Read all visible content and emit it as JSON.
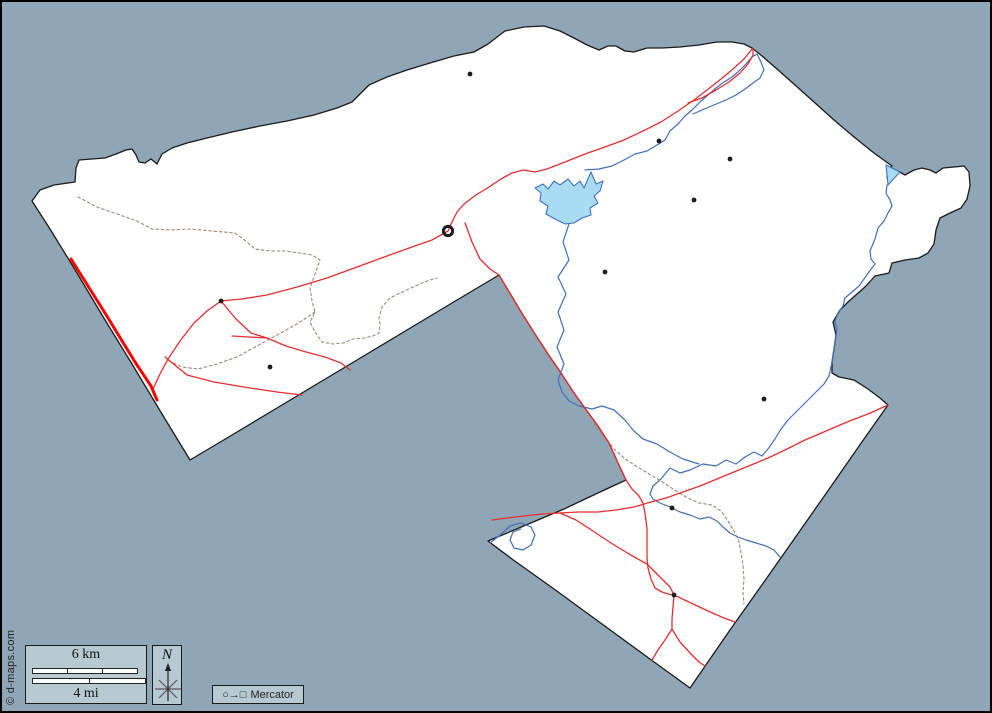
{
  "title": "Blank outline county map with roads, rivers and towns",
  "colors": {
    "sea": "#8fa6b6",
    "land": "#ffffff",
    "outline": "#1a1a1a",
    "river": "#3f6fbf",
    "water_fill": "#a9dbf3",
    "road": "#e62e2e",
    "road_major": "#ff0000",
    "trail": "#9c8674",
    "town": "#1c1c1c",
    "legend_bg": "#b7c9d3"
  },
  "legend": {
    "scale_km": "6 km",
    "scale_mi": "4 mi",
    "north": "N",
    "projection_symbols": "○→□",
    "projection": "Mercator",
    "copyright": "© d-maps.com"
  },
  "map": {
    "outline": "M30,199 L38,188 L52,183 L66,181 L73,180 L74,166 L77,158 L90,157 L103,156 L114,152 L124,148 L130,147 L134,153 L137,160 L143,161 L149,157 L155,162 L160,152 L170,146 L185,141 L205,136 L230,130 L258,124 L285,119 L312,113 L335,106 L350,100 L367,83 L385,75 L405,68 L428,61 L452,54 L472,50 L486,42 L503,29 L522,25 L542,24 L558,29 L572,36 L585,43 L597,48 L606,44 L614,44 L623,49 L632,50 L645,46 L660,46 L678,45 L697,43 L715,40 L730,40 L742,42 L750,46 L760,54 L775,67 L793,83 L812,100 L832,118 L852,135 L872,151 L890,164 L886,167 L885,176 L888,172 L896,169 L903,173 L912,168 L920,166 L928,168 L934,171 L941,166 L952,165 L962,164 L967,170 L968,184 L965,197 L959,206 L948,211 L938,216 L934,228 L932,242 L926,251 L917,256 L903,258 L890,261 L887,271 L873,274 L864,284 L855,292 L846,300 L838,308 L831,320 L834,333 L832,347 L830,360 L830,371 L837,375 L852,378 L866,387 L878,396 L886,403 L862,437 L830,483 L795,533 L762,580 L728,628 L688,686 L648,657 L600,622 L552,587 L510,557 L486,539 L524,523 L562,507 L598,490 L624,478 L617,463 L607,441 L596,424 L585,409 L572,391 L559,371 L546,352 L533,332 L521,313 L509,293 L497,273 L455,298 L410,325 L365,352 L320,379 L275,406 L230,433 L188,458 L160,412 L130,362 L100,313 L72,266 L48,227 Z",
    "lake": "M566,177 L572,184 L578,179 L582,186 L589,170 L594,182 L601,179 L598,189 L592,194 L596,201 L588,206 L589,213 L580,216 L572,221 L563,222 L553,217 L544,212 L546,204 L538,199 L539,191 L533,186 L541,182 L546,187 L552,179 L558,183 Z",
    "bay": "M884,163 L898,170 L886,183 Z",
    "rivers": [
      "M885,183 L884,191 L888,198 L890,204 L886,211 L882,219 L876,226 L873,237 L868,249 L869,257 L873,262 L867,270 L862,277 L857,284 L850,290 L843,296 L841,304 L836,311 L833,319 L835,328 L833,341 L831,354 L829,365 L827,374 L822,382 L814,390 L807,397 L800,404 L793,411 L786,418 L779,427 L773,437 L766,447 L760,454 L752,450 L743,455 L734,462 L724,458 L714,464 L701,462 L688,468 L678,471 L668,466 L659,477 L651,484 L648,492 L651,497 L658,501 L668,505 L678,510 L688,513 L698,517 L707,515 L715,519 L721,525 L728,531 L736,535 L744,538 L754,541 L764,544 L772,548 L778,555",
      "M567,222 L561,240 L567,258 L556,275 L564,292 L556,310 L562,328 L555,345 L562,362 L556,378 L560,390 L567,399 L577,404 L590,407 L600,404 L612,408 L623,418 L631,428 L641,437 L655,442 L668,450 L681,457 L697,462",
      "M583,168 L597,167 L610,164 L622,158 L633,152 L645,149 L655,143 L663,138 L668,129 L676,122 L683,114 L690,108 L698,100 L706,93 L714,86 L722,80 L730,75 L737,69 L744,62 L750,55 L755,52 L759,60 L762,68 L758,76 L751,81 L743,87 L734,93 L724,98 L712,103 L700,108 L691,112",
      "M488,541 L497,534 L508,524 L519,521 L529,525 L533,533 L529,543 L521,548 L512,546 L508,538 L511,530 L519,527"
    ],
    "roads": [
      "M750,47 L742,57 L731,67 L719,77 L705,88 L692,98 L676,109 L659,120 L641,129 L622,138 L603,145 L583,152 L563,160 L545,167 L533,170 L521,168 L510,171 L499,177 L487,185 L474,193 L462,202 L455,210 L450,220 L446,229 L430,238 L410,245 L385,254 L355,265 L325,276 L295,285 L265,293 L240,297 L219,299 L205,309 L192,321 L178,339 L166,357 L158,372 L151,387",
      "M686,101 L700,96 L714,88 L727,80 L738,71 L746,62 L751,53 L751,47",
      "M463,221 L470,240 L478,257 L488,267 L497,273 L509,293 L521,313 L533,332 L546,352 L559,371 L572,391 L585,409 L596,424 L607,441 L617,463 L624,478 L630,487 L637,494 L641,501 L643,511 L645,527 L645,543 L645,556 L646,566 L649,577 L653,586 L660,590 L666,592 L672,593 L671,605 L670,617 L670,627 L678,640 L689,652 L697,660 L703,664",
      "M670,627 L663,638 L656,648 L650,658",
      "M886,403 L866,412 L845,420 L824,429 L803,438 L783,448 L766,456 L749,463 L732,470 L715,477 L698,484 L681,490 L664,496 L649,500 L632,505 L614,508 L596,510 L576,510 L558,511 L540,512 L522,514 L505,516 L490,518",
      "M558,511 L574,518 L591,529 L609,541 L627,552 L645,562 L658,575 L668,585 L672,593 L689,601 L706,609 L722,616 L733,620",
      "M219,299 L234,317 L249,331 L265,336 L284,344 L304,350 L323,355 L339,361 L348,368",
      "M230,334 L247,335 L265,336",
      "M163,355 L185,373 L212,380 L248,386 L275,390 L300,393"
    ],
    "major_road": "M69,257 L103,311 L133,360 L149,384 L155,398",
    "trails": [
      "M76,195 L95,205 L115,212 L135,219 L150,227 L168,228 L188,227 L210,229 L233,231 L245,240 L253,247 L268,249 L283,249 L298,251 L310,253 L318,258 L313,272 L308,286 L310,299 L313,310 L308,320 L313,330 L320,340 L331,342 L341,341 L351,337 L362,336 L371,334 L377,331 L378,322 L377,316 L380,305 L388,296 L398,291 L409,286 L420,281 L428,278 L435,276",
      "M592,422 L602,434 L612,447 L622,456 L634,464 L647,472 L659,479 L671,487 L684,495 L697,501 L710,503 L719,509 L726,519 L732,529 L737,540 L739,551 L741,563 L742,577 L741,590 L742,602",
      "M313,310 L295,322 L275,333 L255,344 L235,355 L215,362 L196,367 L180,365 L167,359"
    ],
    "towns": [
      [
        468,
        72
      ],
      [
        657,
        139
      ],
      [
        728,
        157
      ],
      [
        692,
        198
      ],
      [
        603,
        270
      ],
      [
        762,
        397
      ],
      [
        219,
        299
      ],
      [
        268,
        365
      ],
      [
        670,
        506
      ],
      [
        672,
        593
      ]
    ],
    "seat": {
      "x": 446,
      "y": 229
    }
  }
}
